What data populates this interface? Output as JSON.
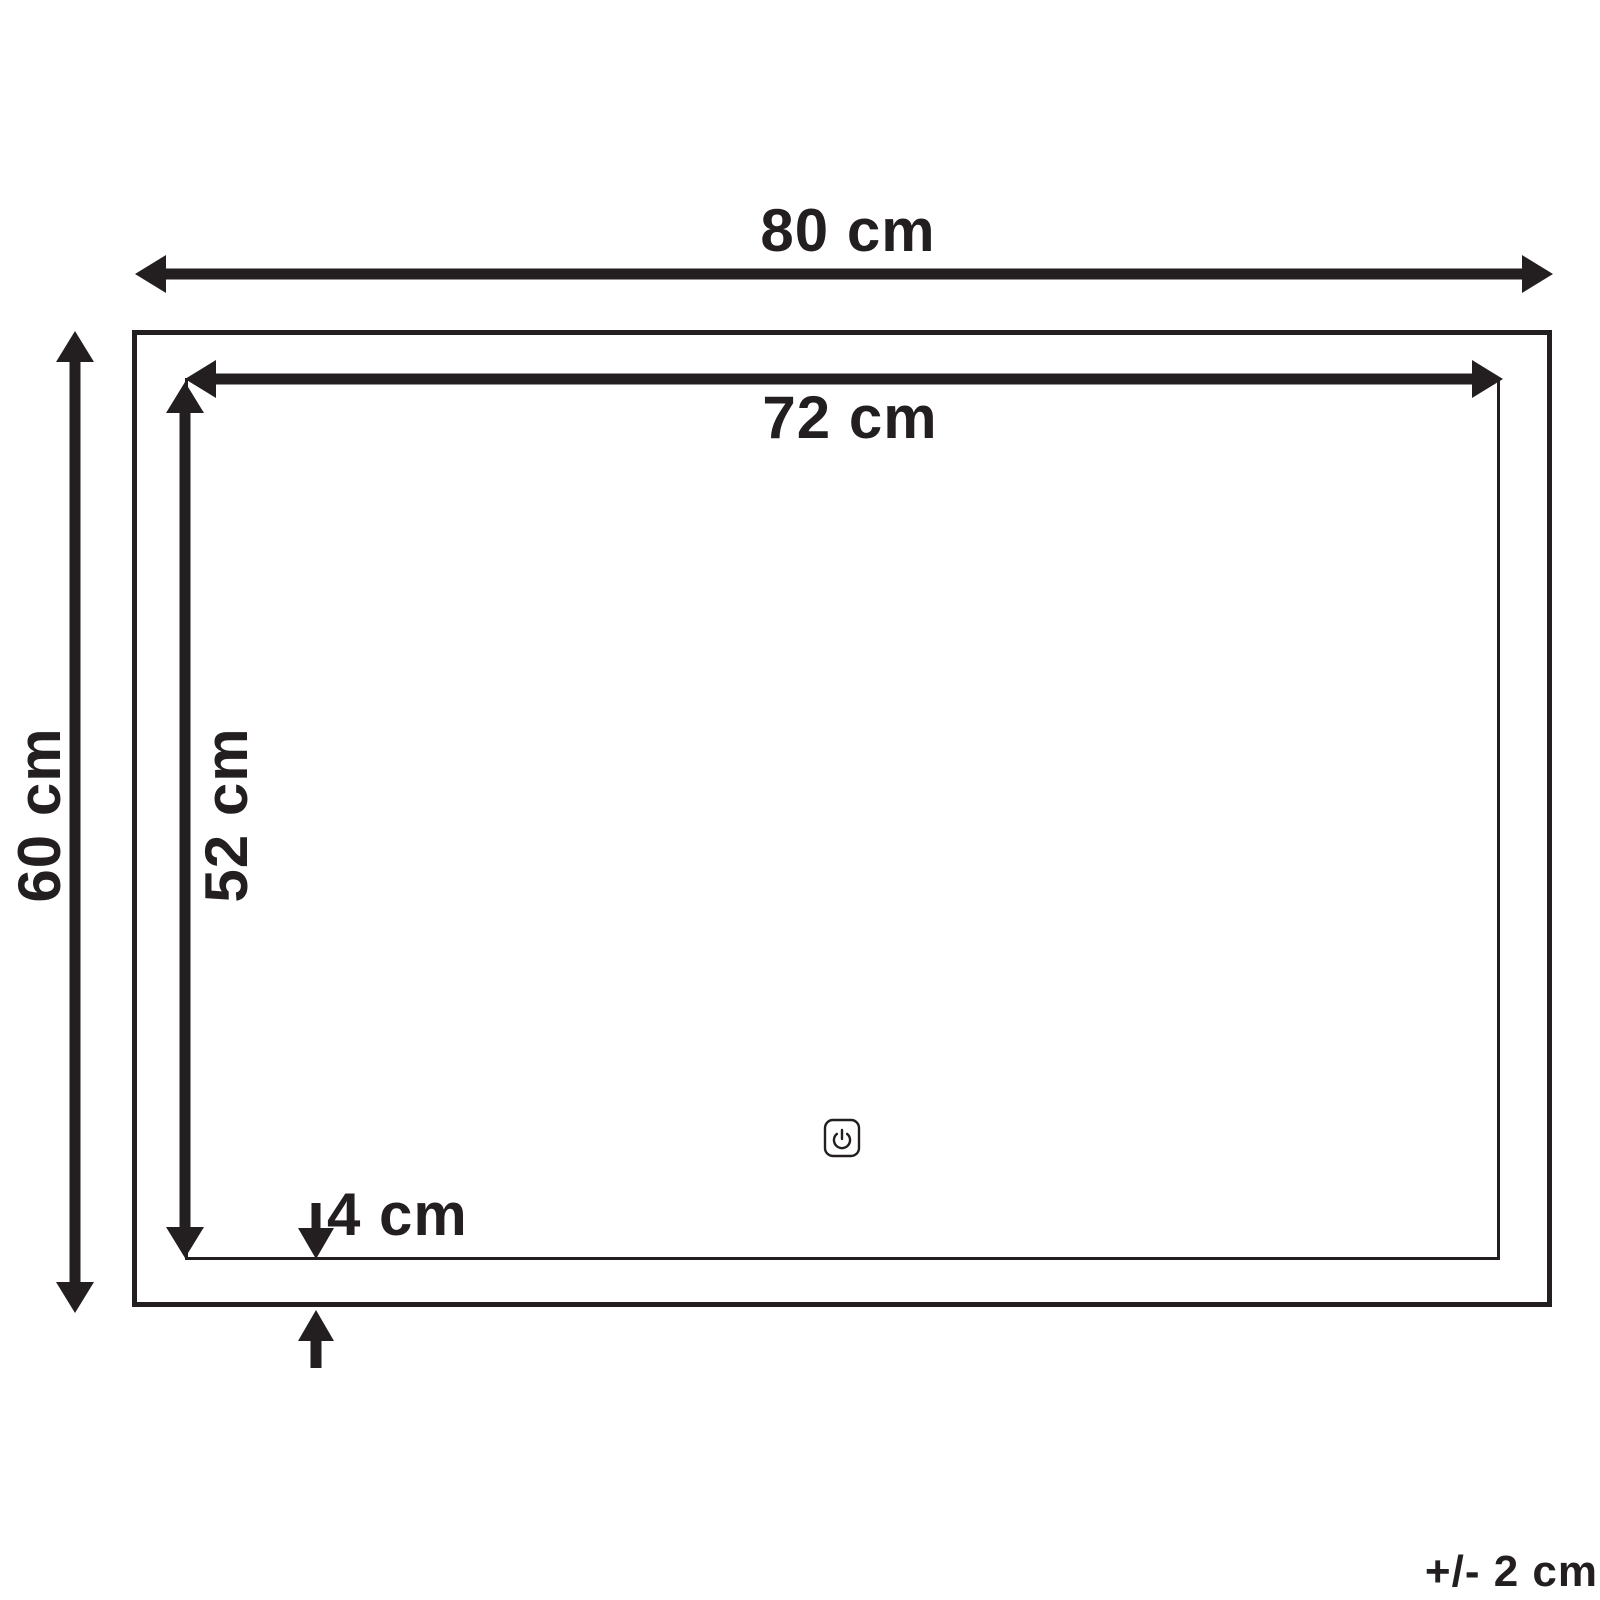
{
  "diagram": {
    "dimensions": {
      "outer_width": "80 cm",
      "outer_height": "60 cm",
      "inner_width": "72 cm",
      "inner_height": "52 cm",
      "frame_depth": "4 cm"
    },
    "tolerance": "+/- 2 cm",
    "icons": {
      "power_button": "power-icon"
    },
    "colors": {
      "line": "#231f20",
      "background": "#ffffff"
    }
  }
}
